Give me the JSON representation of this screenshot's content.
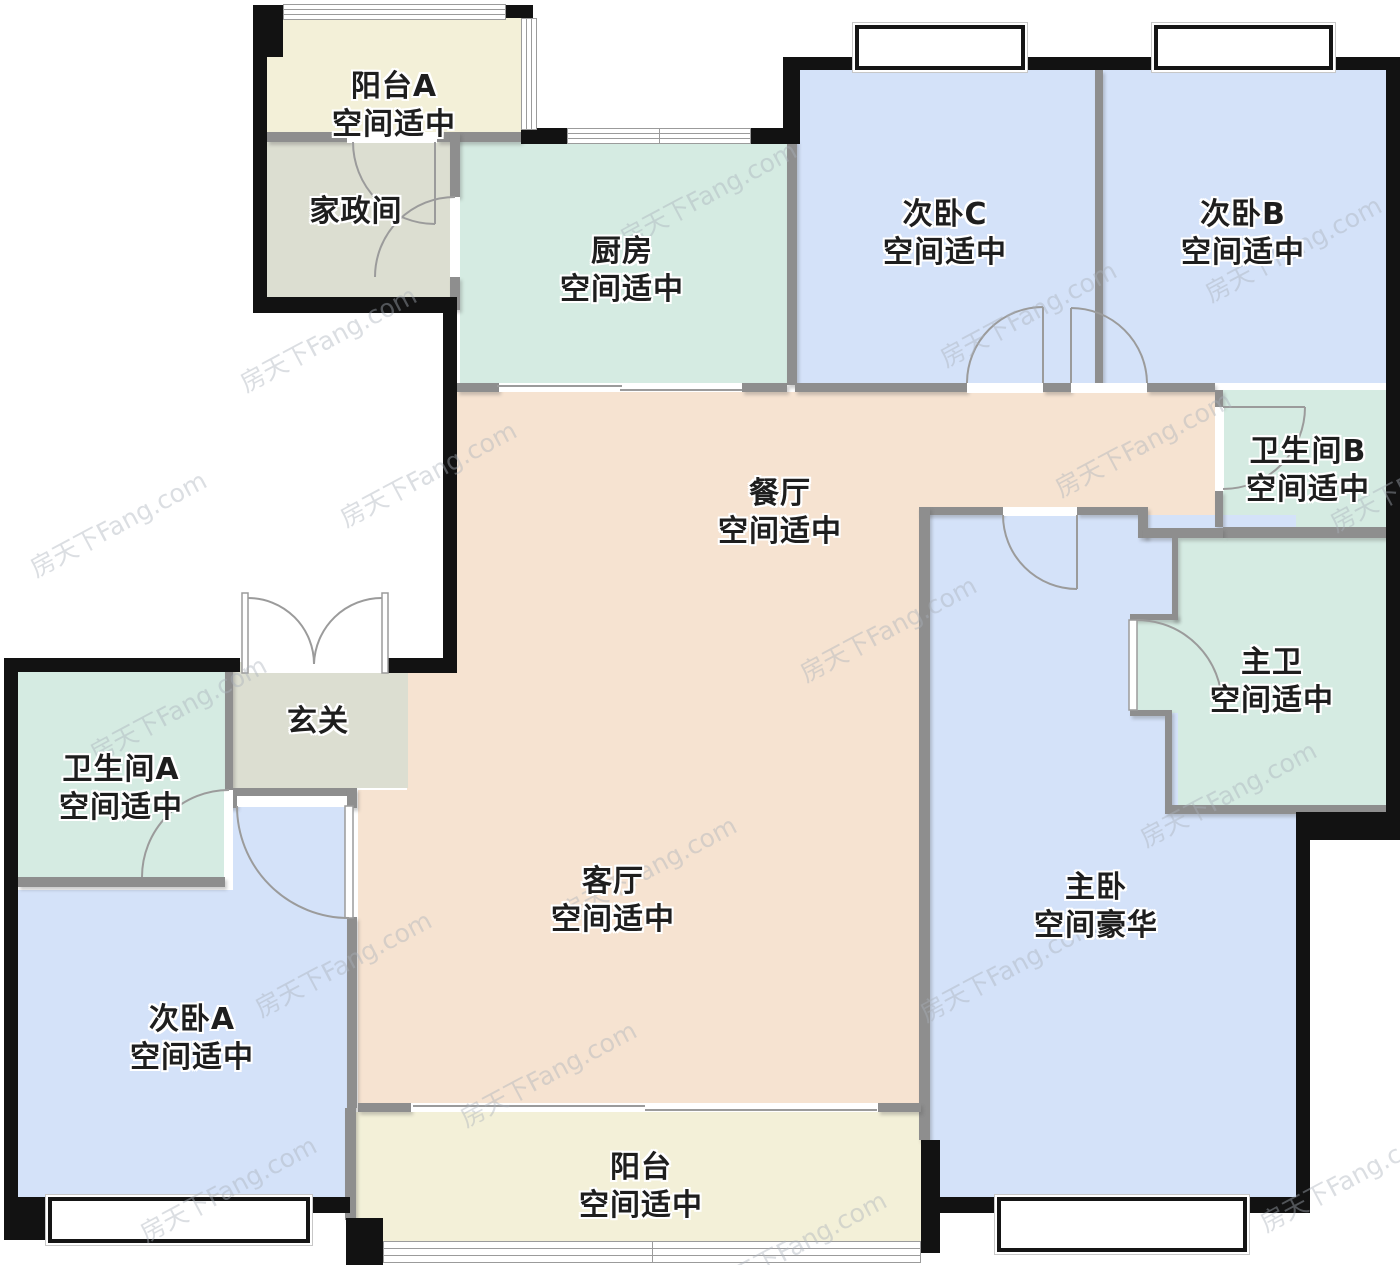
{
  "watermark": {
    "text": "房天下Fang.com"
  },
  "rooms": {
    "balcony_a": {
      "name": "阳台A",
      "grade": "空间适中"
    },
    "housekeeping": {
      "name": "家政间",
      "grade": ""
    },
    "kitchen": {
      "name": "厨房",
      "grade": "空间适中"
    },
    "bedroom_c": {
      "name": "次卧C",
      "grade": "空间适中"
    },
    "bedroom_b": {
      "name": "次卧B",
      "grade": "空间适中"
    },
    "bathroom_b": {
      "name": "卫生间B",
      "grade": "空间适中"
    },
    "dining": {
      "name": "餐厅",
      "grade": "空间适中"
    },
    "master_bath": {
      "name": "主卫",
      "grade": "空间适中"
    },
    "hallway": {
      "name": "玄关",
      "grade": ""
    },
    "bathroom_a": {
      "name": "卫生间A",
      "grade": "空间适中"
    },
    "living": {
      "name": "客厅",
      "grade": "空间适中"
    },
    "master_bedroom": {
      "name": "主卧",
      "grade": "空间豪华"
    },
    "bedroom_a": {
      "name": "次卧A",
      "grade": "空间适中"
    },
    "balcony": {
      "name": "阳台",
      "grade": "空间适中"
    }
  },
  "colors": {
    "balcony": "#f3f0d8",
    "utility": "#dcded1",
    "wet": "#d5ebe2",
    "bedroom": "#d4e2f9",
    "living": "#f6e3d1",
    "wall-exterior": "#121212",
    "wall-interior": "#8e8e8e",
    "door-stroke": "#9b9b9b"
  }
}
